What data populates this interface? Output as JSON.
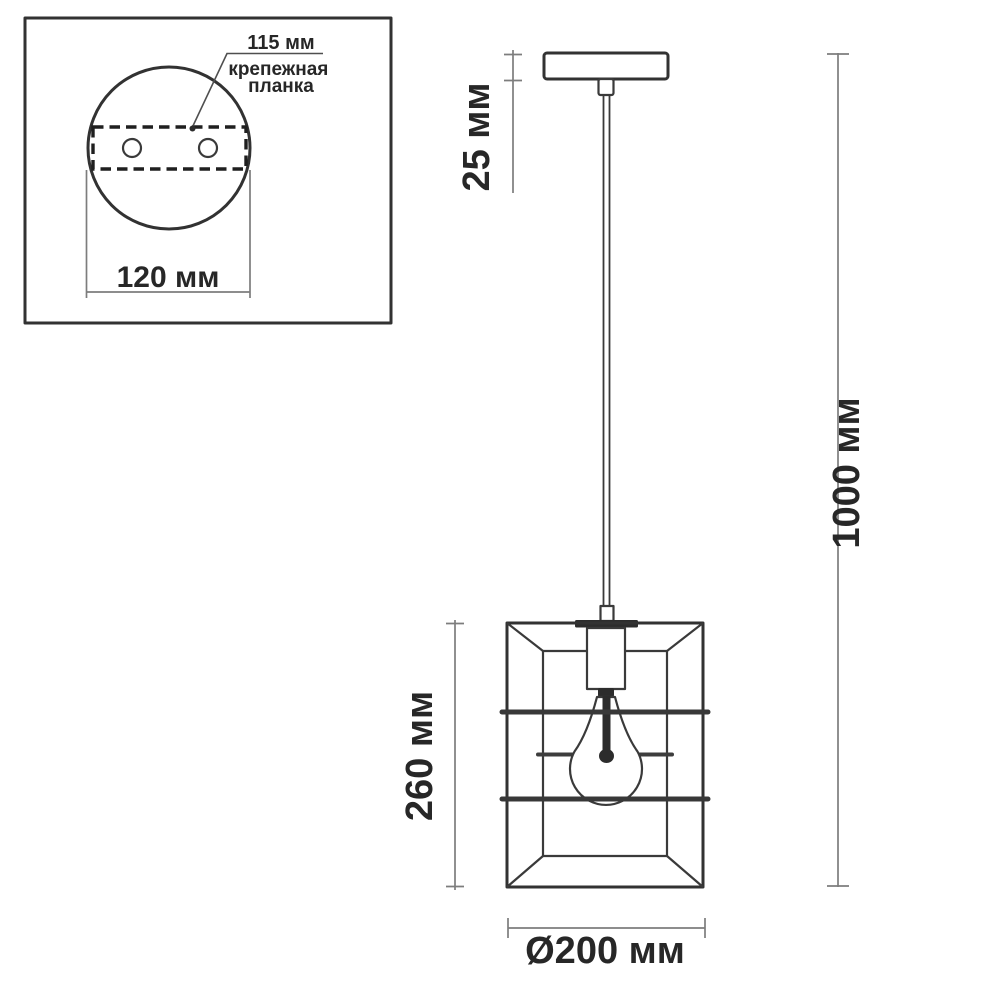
{
  "title": "pendant-lamp-dimension-drawing",
  "inset": {
    "hole_spacing_label": "115 мм",
    "mount_label_line1": "крепежная",
    "mount_label_line2": "планка",
    "base_width_label": "120 мм"
  },
  "main": {
    "canopy_height_label": "25 мм",
    "shade_height_label": "260 мм",
    "total_height_label": "1000 мм",
    "shade_diameter_label": "Ø200 мм"
  },
  "dimensions_mm": {
    "mounting_plate_hole_spacing": 115,
    "ceiling_base_width": 120,
    "canopy_height": 25,
    "shade_height": 260,
    "total_height": 1000,
    "shade_diameter": 200
  },
  "colors": {
    "background": "#ffffff",
    "drawing_line": "#323232",
    "dimension_line": "#7d7d7d",
    "text": "#272727"
  }
}
